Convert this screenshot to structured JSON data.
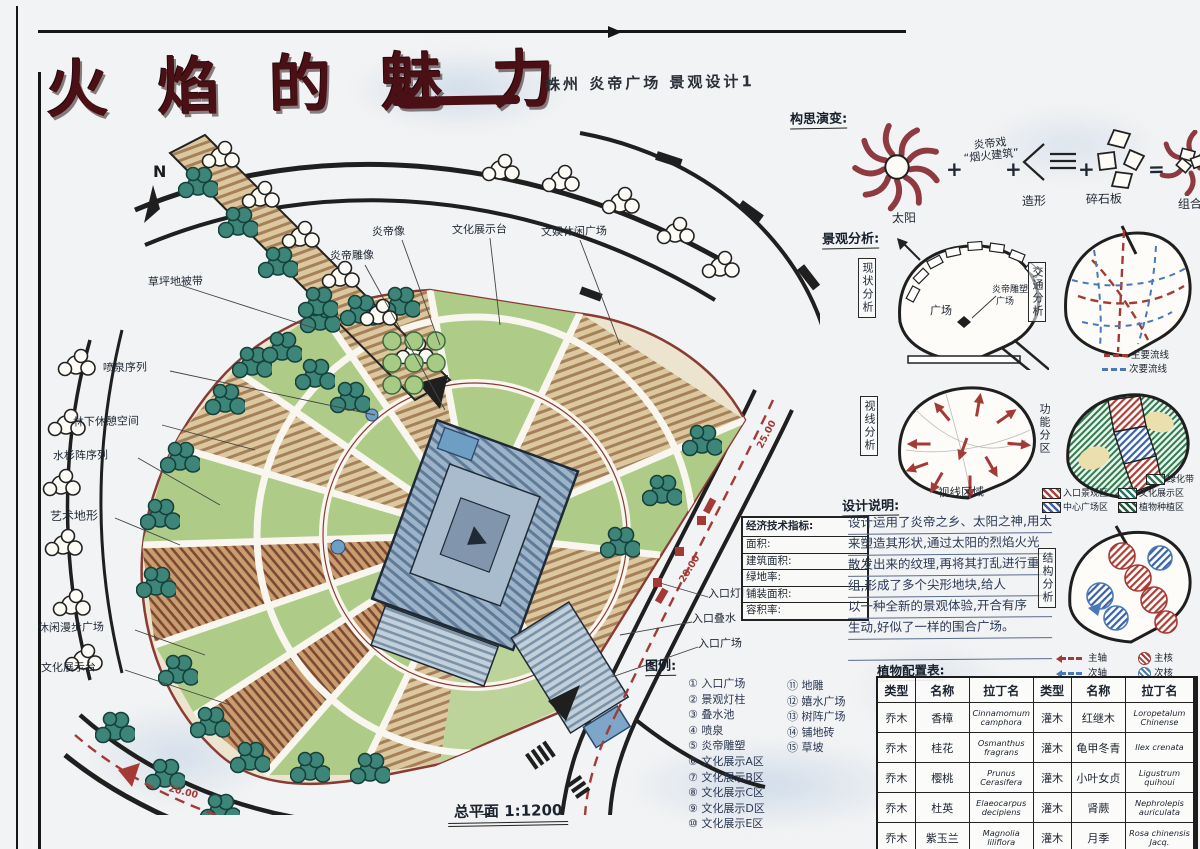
{
  "title": {
    "main": "火 焰 的 魅 力",
    "subtitle": "株州 炎帝广场 景观设计1"
  },
  "north": "N",
  "plan": {
    "caption": "总平面 1:1200",
    "labels": {
      "left": [
        "草坪地被带",
        "喷泉序列",
        "林下休憩空间",
        "水杉阵序列",
        "艺术地形",
        "休闲漫步广场",
        "文化展示台"
      ],
      "top": [
        "炎帝雕像",
        "炎帝像",
        "文化展示台",
        "文娱休闲广场"
      ],
      "right": [
        "入口灯柱",
        "入口叠水",
        "入口广场"
      ]
    },
    "dims": [
      "20.00",
      "20.00",
      "25.00",
      "28.00"
    ],
    "indicators": {
      "title": "经济技术指标:",
      "rows": [
        "面积:",
        "建筑面积:",
        "绿地率:",
        "铺装面积:",
        "容积率:"
      ]
    }
  },
  "concept": {
    "heading": "构思演变:",
    "sun_label": "太阳",
    "plus": "+",
    "equals": "=",
    "idea1_l1": "炎帝戏",
    "idea1_l2": "“烟火建筑”",
    "shape_label": "造形",
    "slab_label": "碎石板",
    "result_label": "组合"
  },
  "analysis": {
    "heading": "景观分析:",
    "current": {
      "label": "现状分析",
      "plaza": "广场",
      "pointer1": "炎帝雕塑",
      "pointer2": "广场"
    },
    "traffic": {
      "label": "交通分析",
      "legend": [
        {
          "name": "主要流线",
          "color": "#a43a35"
        },
        {
          "name": "次要流线",
          "color": "#4a7ab5"
        }
      ]
    },
    "sight": {
      "label": "视线分析",
      "caption": "视线区域"
    },
    "zoning": {
      "label": "功能分区",
      "legend": [
        {
          "name": "绿化带",
          "color": "#2e7d52"
        },
        {
          "name": "入口景观区",
          "color": "#b04036"
        },
        {
          "name": "文化展示区",
          "color": "#1f7a6d"
        },
        {
          "name": "中心广场区",
          "color": "#3a62a8"
        },
        {
          "name": "植物种植区",
          "color": "#1e5b38"
        }
      ]
    },
    "structure": {
      "label": "结构分析",
      "legend": [
        {
          "name": "主轴",
          "color": "#a43a35"
        },
        {
          "name": "次轴",
          "color": "#4a7ab5"
        },
        {
          "name": "主核",
          "color": "#a43a35"
        },
        {
          "name": "次核",
          "color": "#4a7ab5"
        }
      ]
    }
  },
  "notes": {
    "heading": "设计说明:",
    "lines": [
      "设计运用了炎帝之乡、太阳之神,用太阳",
      "来塑造其形状,通过太阳的烈焰火光",
      "散发出来的纹理,再将其打乱进行重",
      "组,形成了多个尖形地块,给人",
      "以一种全新的景观体验,开合有序",
      "生动,好似了一样的围合广场。"
    ]
  },
  "legend": {
    "heading": "图例:",
    "col1": [
      "① 入口广场",
      "② 景观灯柱",
      "③ 叠水池",
      "④ 喷泉",
      "⑤ 炎帝雕塑",
      "⑥ 文化展示A区",
      "⑦ 文化展示B区",
      "⑧ 文化展示C区",
      "⑨ 文化展示D区",
      "⑩ 文化展示E区"
    ],
    "col2": [
      "⑪ 地雕",
      "⑫ 嬉水广场",
      "⑬ 树阵广场",
      "⑭ 铺地砖",
      "⑮ 草坡"
    ]
  },
  "plants": {
    "heading": "植物配置表:",
    "headers": [
      "类型",
      "名称",
      "拉丁名",
      "类型",
      "名称",
      "拉丁名"
    ],
    "rows": [
      [
        "乔木",
        "香樟",
        "Cinnamomum camphora",
        "灌木",
        "红继木",
        "Loropetalum Chinense"
      ],
      [
        "乔木",
        "桂花",
        "Osmanthus fragrans",
        "灌木",
        "龟甲冬青",
        "Ilex crenata"
      ],
      [
        "乔木",
        "樱桃",
        "Prunus Cerasifera",
        "灌木",
        "小叶女贞",
        "Ligustrum quihoui"
      ],
      [
        "乔木",
        "杜英",
        "Elaeocarpus decipiens",
        "灌木",
        "肾蕨",
        "Nephrolepis auriculata"
      ],
      [
        "乔木",
        "紫玉兰",
        "Magnolia liliflora",
        "灌木",
        "月季",
        "Rosa chinensis Jacq."
      ]
    ]
  }
}
